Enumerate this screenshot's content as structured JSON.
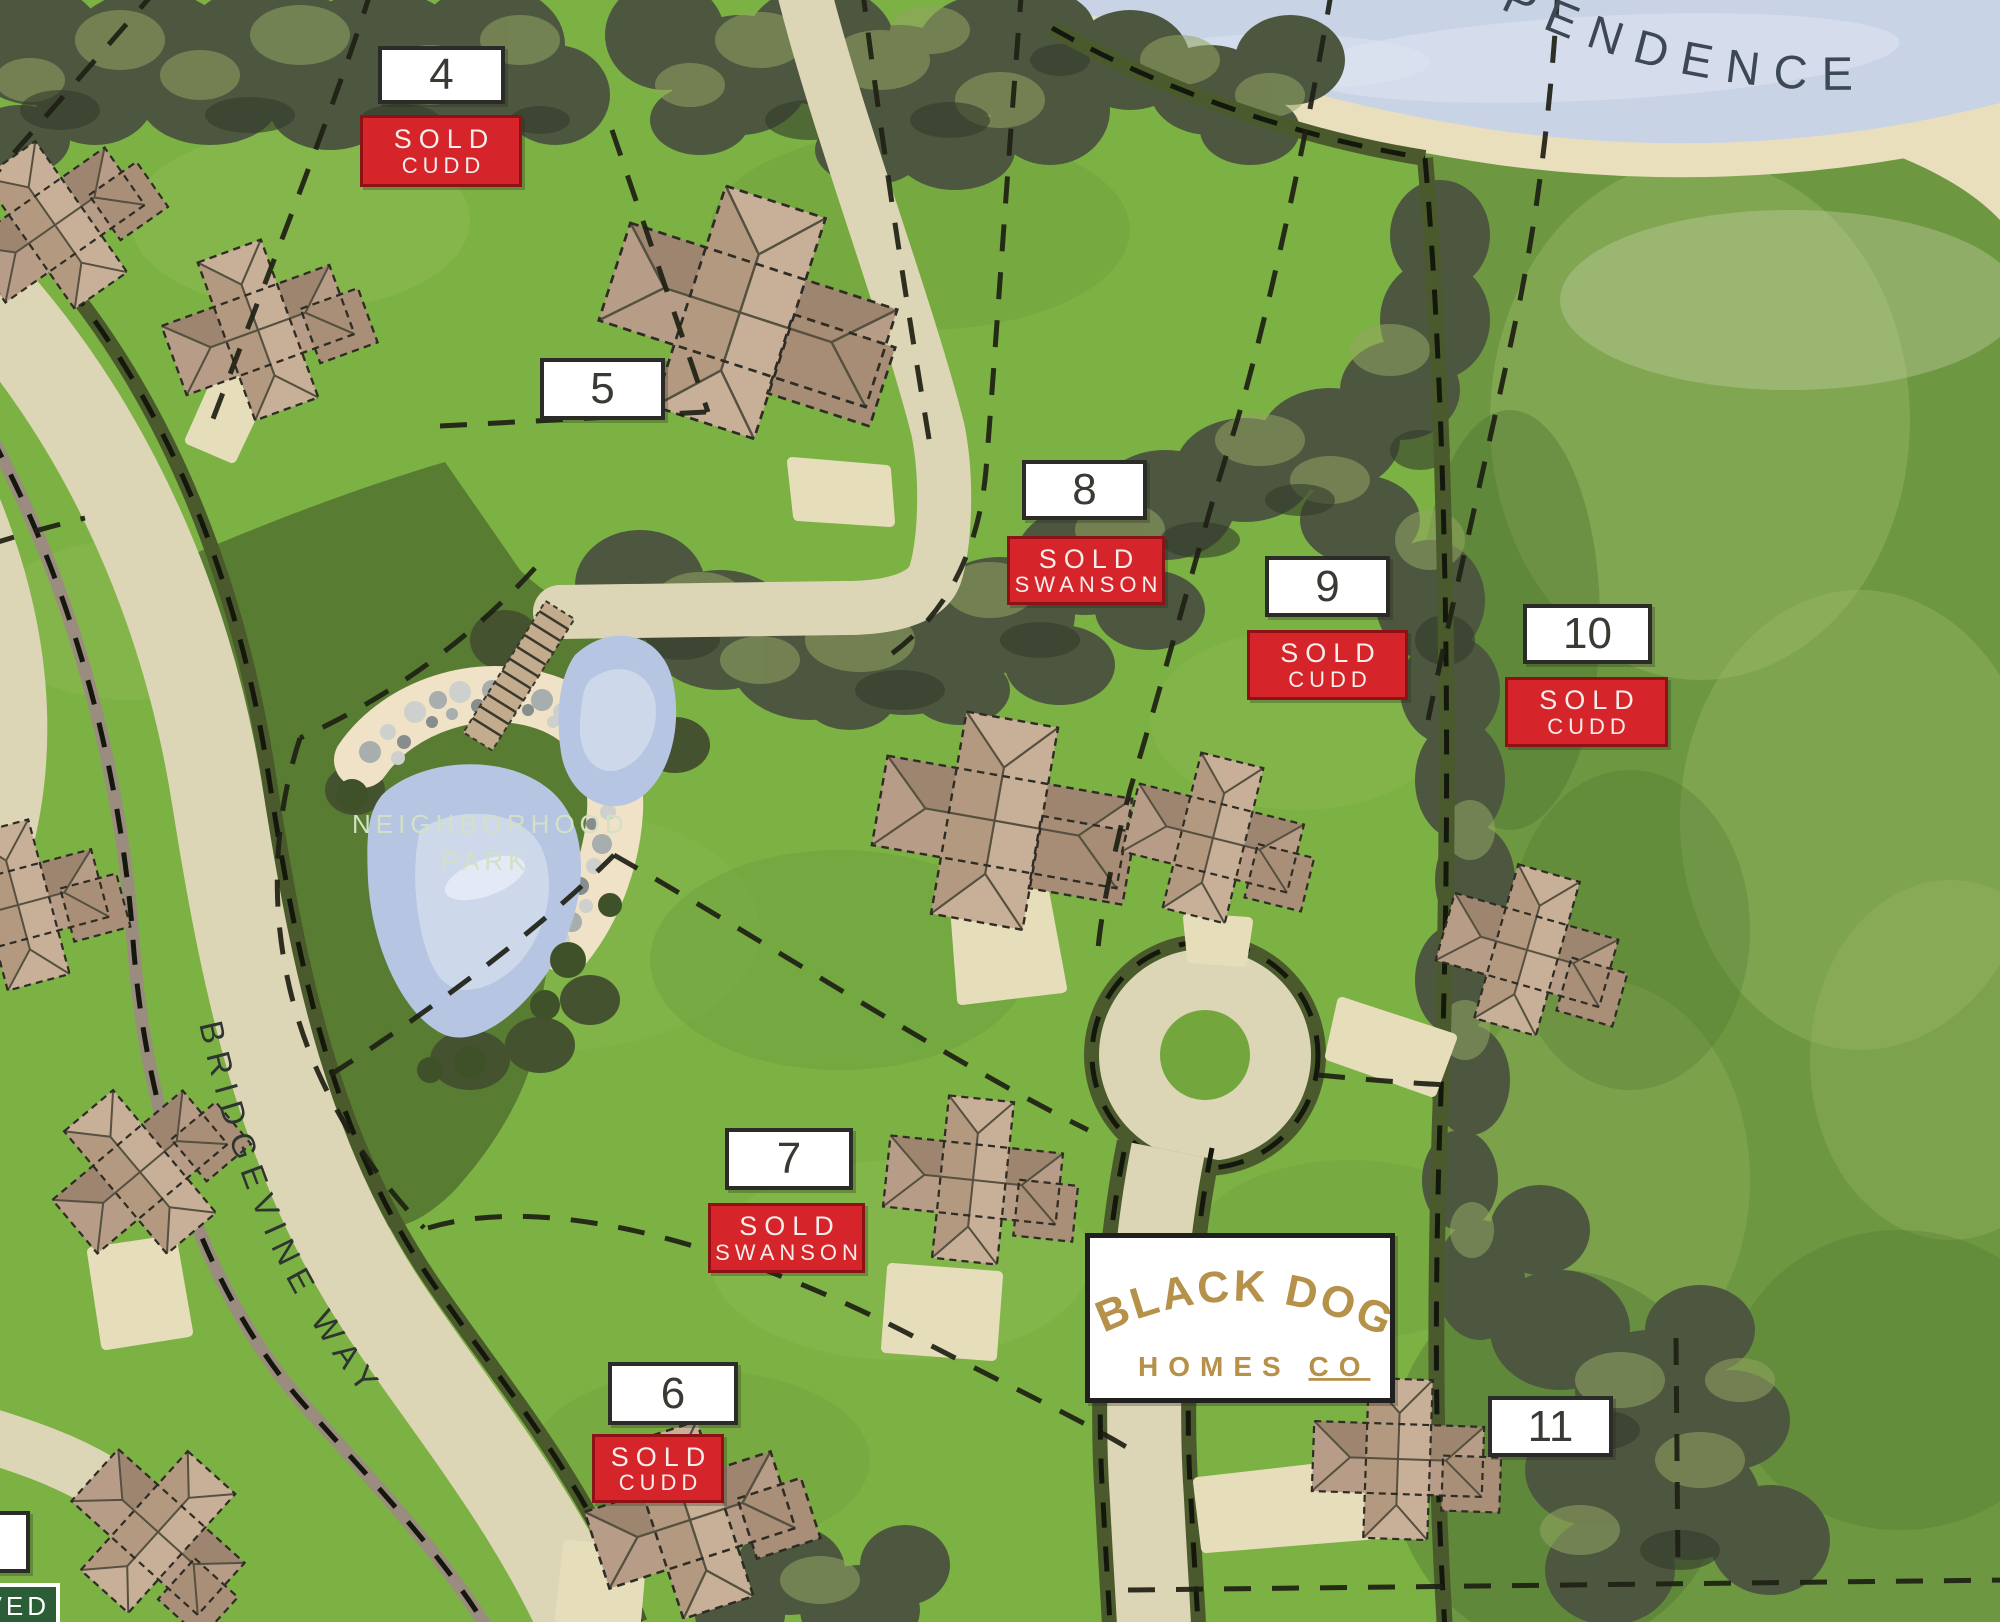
{
  "map_title": "Black Dog Homes Co neighborhood site plan",
  "lake": {
    "label": "EPENDENCE"
  },
  "park": {
    "line1": "NEIGHBORHOOD",
    "line2": "PARK"
  },
  "street": {
    "name": "BRIDGEVINE WAY"
  },
  "reserved": {
    "label": "VED"
  },
  "logo": {
    "top": "BLACK DOG",
    "homes": "HOMES ",
    "co": "CO"
  },
  "lots": [
    {
      "number": "4",
      "status": "SOLD",
      "buyer": "CUDD"
    },
    {
      "number": "5",
      "status": "",
      "buyer": ""
    },
    {
      "number": "6",
      "status": "SOLD",
      "buyer": "CUDD"
    },
    {
      "number": "7",
      "status": "SOLD",
      "buyer": "SWANSON"
    },
    {
      "number": "8",
      "status": "SOLD",
      "buyer": "SWANSON"
    },
    {
      "number": "9",
      "status": "SOLD",
      "buyer": "CUDD"
    },
    {
      "number": "10",
      "status": "SOLD",
      "buyer": "CUDD"
    },
    {
      "number": "11",
      "status": "",
      "buyer": ""
    }
  ],
  "colors": {
    "grass": "#7cb144",
    "park_green": "#587c31",
    "tree_dark": "#4d5740",
    "road": "#ddd6b6",
    "trail_olive": "#4a5a2c",
    "water": "#c9d3e6",
    "sand": "#e9dfbd",
    "sold_red": "#d5242a",
    "badge_border": "#2b2b28",
    "logo_gold": "#b5914a",
    "reserved_green": "#2b5d37"
  }
}
